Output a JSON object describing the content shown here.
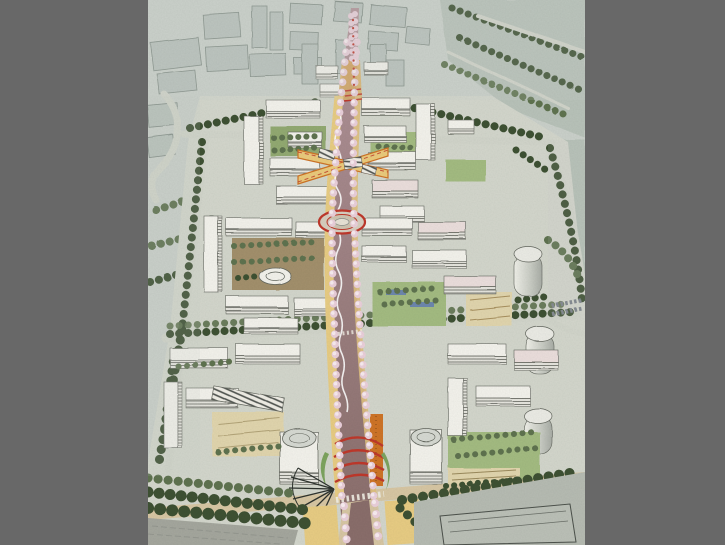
{
  "window": {
    "background_color": "#686868"
  },
  "artwork": {
    "description": "Aerial perspective watercolor rendering of a mixed-use urban district masterplan: white mid-rise blocks with green courtyards flank a central cherry-blossom boulevard that runs from a distant gateway at the top to a plaza terminus with red arches at the bottom; sketchy gray-green city context and a riverside greenway surround the site.",
    "image_left_px": 148,
    "image_width_px": 437,
    "image_height_px": 545,
    "palette": {
      "window_gray": "#686868",
      "paper": "#cbd1cb",
      "ground": "#d4d7cd",
      "bg_building": "#bac3bd",
      "bg_outline": "#848f88",
      "greenway_field": "#b7c2b8",
      "tree_dark": "#3e5133",
      "tree_mid": "#5f7350",
      "tree_light": "#7e9468",
      "blossom_pink": "#ebd0db",
      "blossom_white": "#faeef2",
      "building_white": "#f4f3ed",
      "building_face": "#e7e6df",
      "building_line": "#64675f",
      "roof_pink": "#ecdfdd",
      "boulevard_hi": "#b2949a",
      "boulevard_lo": "#8a6e6b",
      "path_tan": "#d8c7a4",
      "plaza_yellow": "#e9cd84",
      "plaza_orange": "#e2ab52",
      "orange_deep": "#cf7427",
      "accent_red": "#bf382b",
      "lawn": "#a4bc82",
      "courtyard_green": "#93aa72",
      "courtyard_brown": "#a3906c",
      "checker": "#e2d6ae",
      "pond_blue": "#6d87ae",
      "water_gray": "#a5a79e",
      "street": "#d2d5cb",
      "fan_dark": "#2e332e"
    }
  }
}
